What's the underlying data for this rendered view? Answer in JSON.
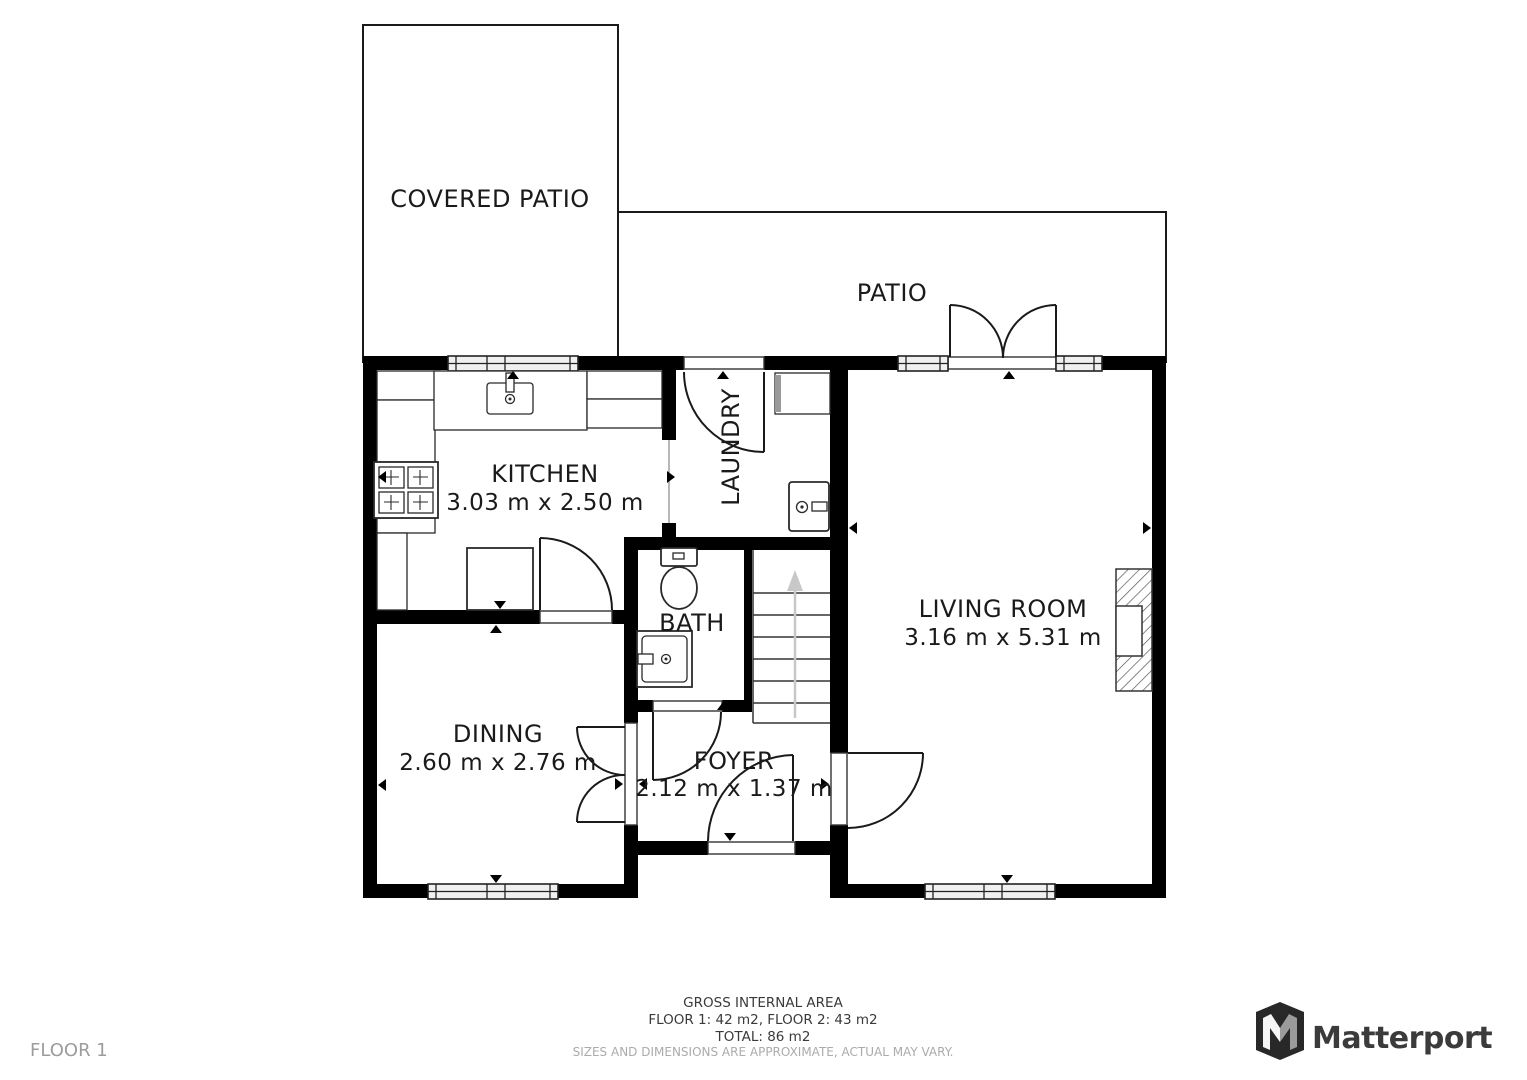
{
  "page": {
    "floor_label": "FLOOR 1"
  },
  "rooms": {
    "covered_patio": {
      "label": "COVERED PATIO"
    },
    "patio": {
      "label": "PATIO"
    },
    "kitchen": {
      "label": "KITCHEN",
      "dimensions": "3.03 m x 2.50 m"
    },
    "laundry": {
      "label": "LAUNDRY"
    },
    "living_room": {
      "label": "LIVING ROOM",
      "dimensions": "3.16 m x 5.31 m"
    },
    "bath": {
      "label": "BATH"
    },
    "dining": {
      "label": "DINING",
      "dimensions": "2.60 m x 2.76 m"
    },
    "foyer": {
      "label": "FOYER",
      "dimensions": "2.12 m x 1.37 m"
    }
  },
  "footer": {
    "gross_area_title": "GROSS INTERNAL AREA",
    "floor_areas": "FLOOR 1: 42 m2, FLOOR 2: 43 m2",
    "total_area": "TOTAL: 86 m2",
    "disclaimer": "SIZES AND DIMENSIONS ARE APPROXIMATE, ACTUAL MAY VARY."
  },
  "branding": {
    "wordmark": "Matterport"
  },
  "colors": {
    "wall": "#000000",
    "text": "#1a1a1a",
    "muted_text": "#9c9c9c",
    "stair_arrow": "#c8c8c8",
    "window_fill": "#f0f0f0"
  }
}
